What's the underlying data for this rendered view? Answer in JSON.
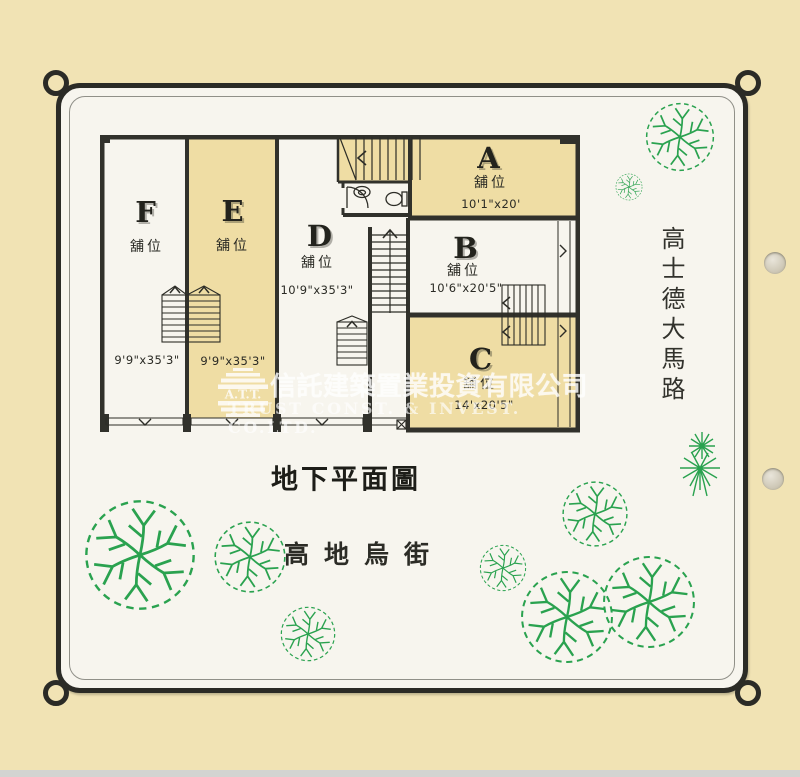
{
  "plan": {
    "title": "地下平面圖",
    "units": [
      {
        "letter": "F",
        "type_label": "舖位",
        "dimensions": "9'9\"x35'3\""
      },
      {
        "letter": "E",
        "type_label": "舖位",
        "dimensions": "9'9\"x35'3\""
      },
      {
        "letter": "D",
        "type_label": "舖位",
        "dimensions": "10'9\"x35'3\""
      },
      {
        "letter": "A",
        "type_label": "舖位",
        "dimensions": "10'1\"x20'"
      },
      {
        "letter": "B",
        "type_label": "舖位",
        "dimensions": "10'6\"x20'5\""
      },
      {
        "letter": "C",
        "type_label": "舖位",
        "dimensions": "14'x20'5\""
      }
    ]
  },
  "streets": {
    "right_vertical": "高士德大馬路",
    "bottom": "高地烏街"
  },
  "watermark": {
    "logo_text": "A.T.T.",
    "chinese": "信託建築置業投資有限公司",
    "english": "TRUST CONST. & INVEST. CO.LTD."
  },
  "colors": {
    "page_background": "#f1e3b4",
    "card_background": "#f7f5ee",
    "unit_highlight": "#efdda4",
    "wall": "#31312b",
    "tree_green": "#2aa24f",
    "watermark": "#ffffff"
  }
}
